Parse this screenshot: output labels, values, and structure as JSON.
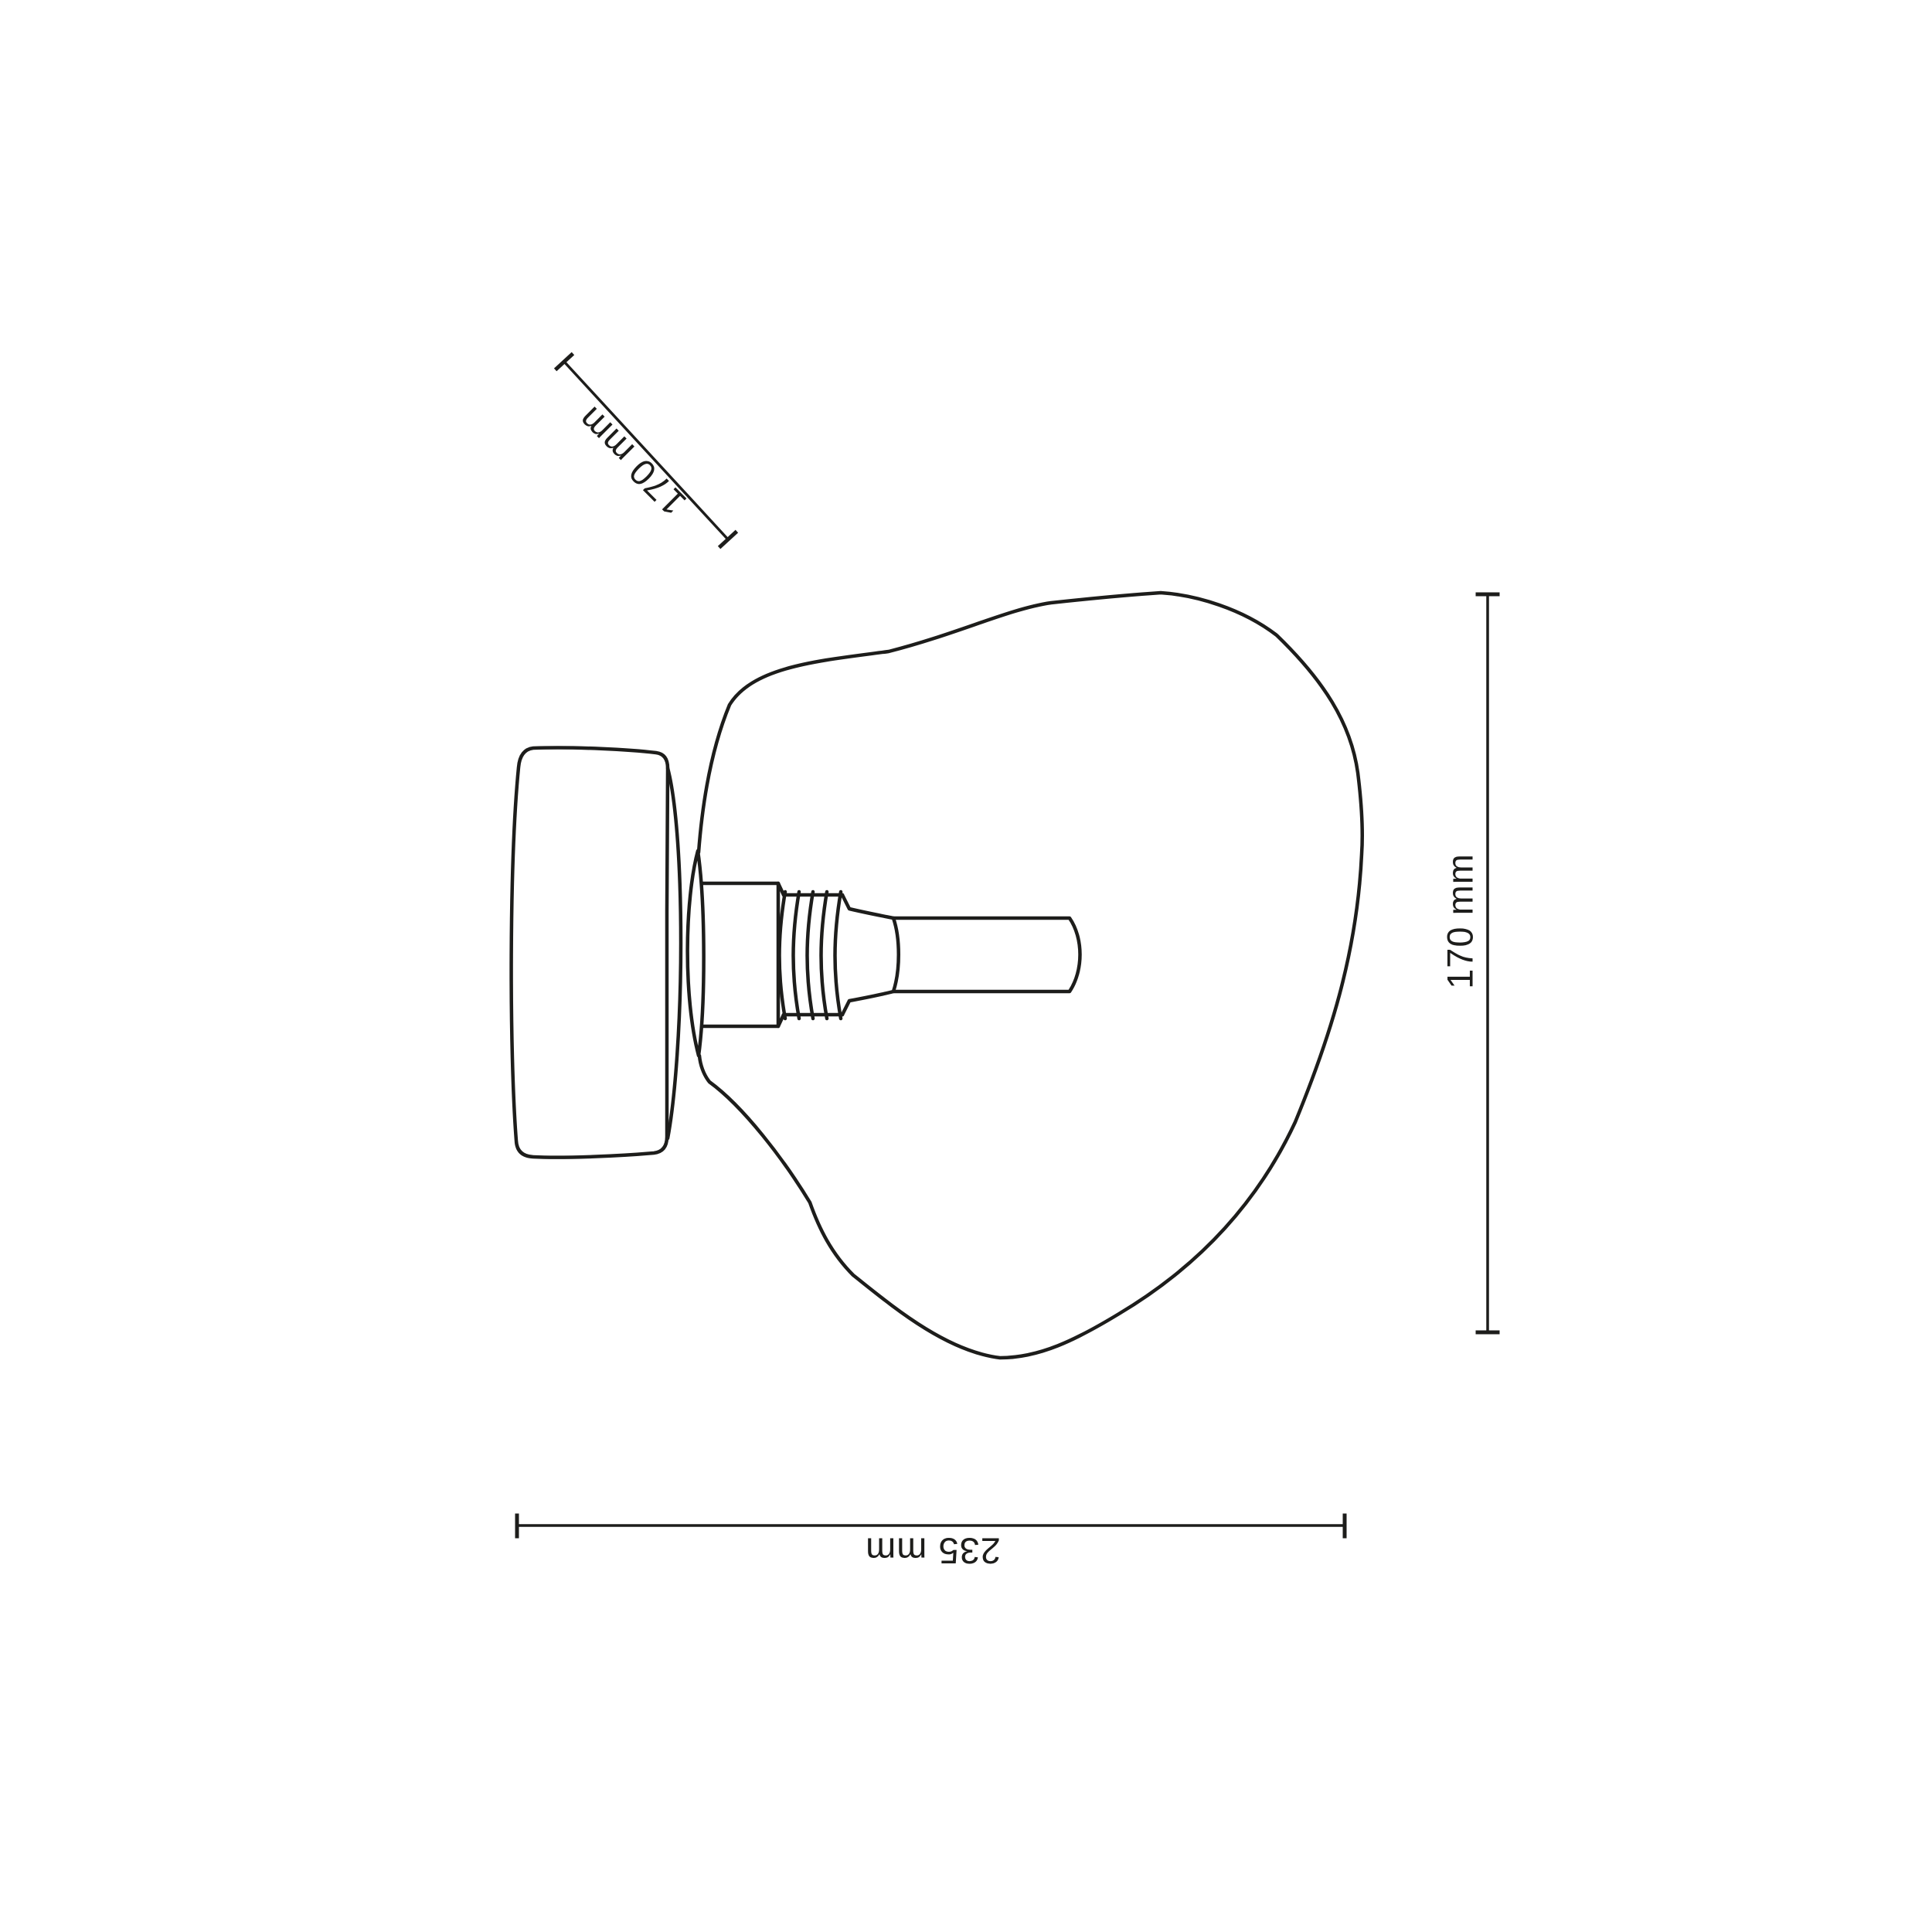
{
  "canvas": {
    "background_color": "#ffffff",
    "line_color": "#1d1d1b",
    "text_color": "#1d1d1b"
  },
  "drawing": {
    "subject": "wall lamp with organic glass shade, wall mount and tubular bulb, line drawing"
  },
  "dimensions": {
    "depth": {
      "label": "170 mm"
    },
    "height": {
      "label": "170 mm"
    },
    "width": {
      "label": "235 mm"
    }
  }
}
